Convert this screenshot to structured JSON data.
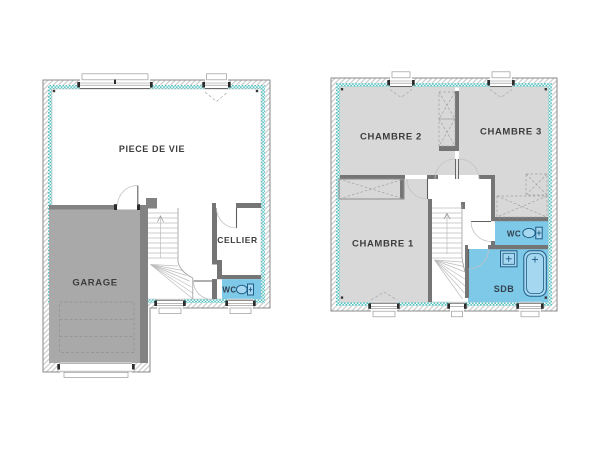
{
  "colors": {
    "insulation_teal": "#4ec0c0",
    "hatch_line": "#cbcbcb",
    "room_gray": "#d8d8d8",
    "garage_gray": "#a9a9a9",
    "garage_wall": "#828282",
    "wall_dark": "#757575",
    "wet_blue": "#7ec8e8",
    "fixture_stroke": "#1f5c86",
    "label_color": "#3d3d3d"
  },
  "plans": {
    "ground": {
      "rooms": [
        {
          "id": "piece-de-vie",
          "label": "PIECE DE VIE"
        },
        {
          "id": "garage",
          "label": "GARAGE"
        },
        {
          "id": "cellier",
          "label": "CELLIER"
        },
        {
          "id": "wc",
          "label": "WC"
        }
      ]
    },
    "first": {
      "rooms": [
        {
          "id": "chambre-2",
          "label": "CHAMBRE 2"
        },
        {
          "id": "chambre-3",
          "label": "CHAMBRE 3"
        },
        {
          "id": "chambre-1",
          "label": "CHAMBRE 1"
        },
        {
          "id": "wc",
          "label": "WC"
        },
        {
          "id": "sdb",
          "label": "SDB"
        }
      ]
    }
  },
  "icons": {
    "toilet": "toilet-icon",
    "sink": "sink-icon",
    "bathtub": "bathtub-icon",
    "stairs_arrow": "up-arrow-icon"
  }
}
